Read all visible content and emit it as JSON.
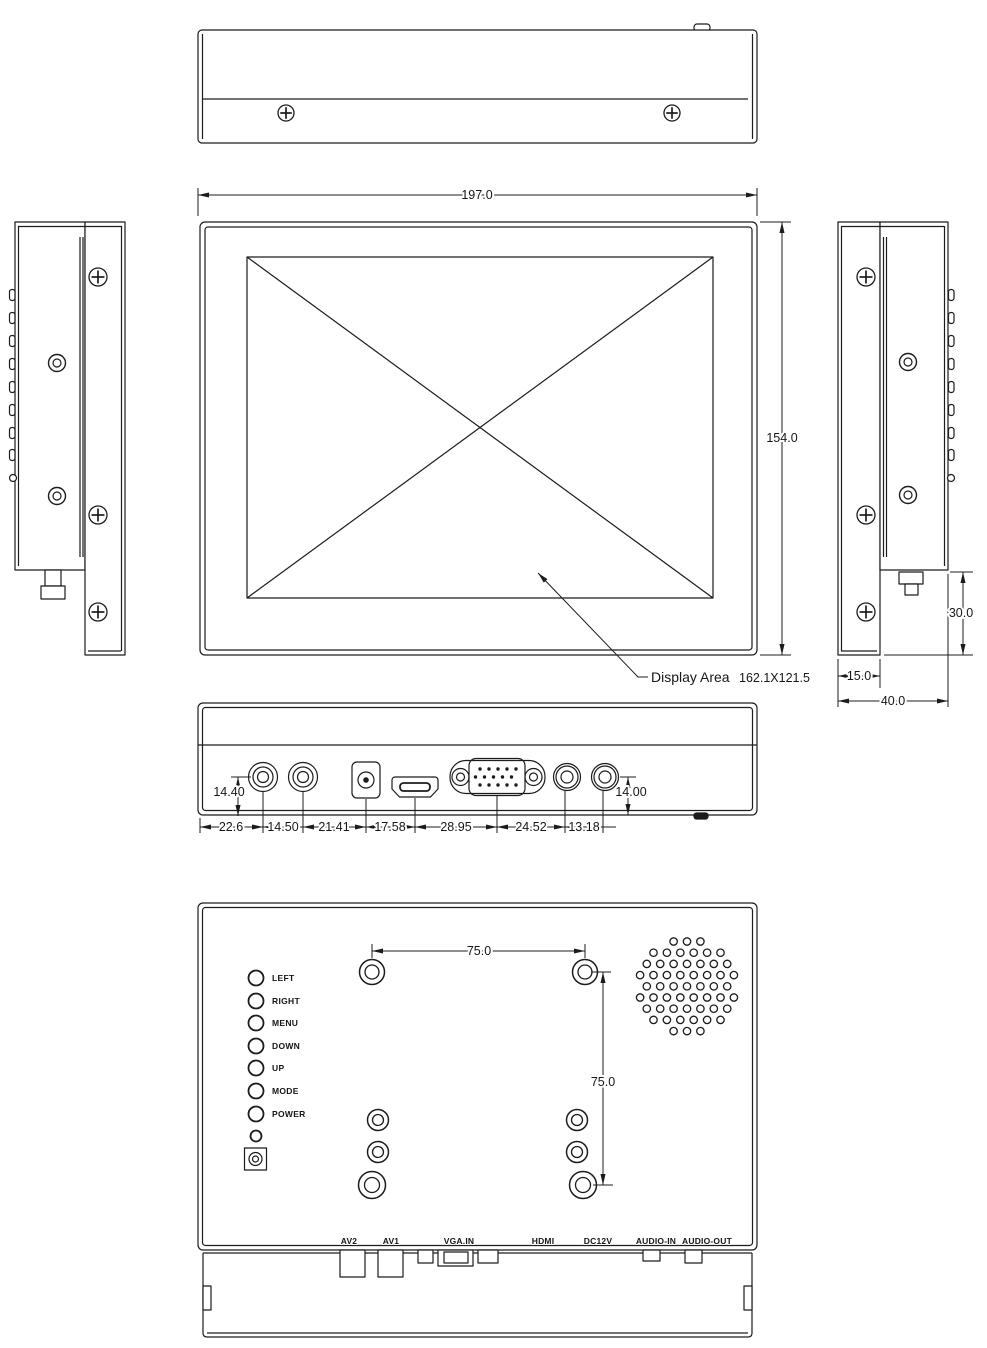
{
  "front_view": {
    "width": "197.0",
    "height": "154.0",
    "display_area": {
      "label": "Display Area",
      "size": "162.1X121.5"
    }
  },
  "side_view": {
    "mount_height": "30.0",
    "bezel_depth": "15.0",
    "total_depth": "40.0"
  },
  "bottom_view": {
    "jack_height_left": "14.40",
    "jack_height_right": "14.00",
    "spacings": [
      "22.6",
      "14.50",
      "21.41",
      "17.58",
      "28.95",
      "24.52",
      "13.18"
    ]
  },
  "back_view": {
    "vesa_horizontal": "75.0",
    "vesa_vertical": "75.0",
    "buttons": [
      "LEFT",
      "RIGHT",
      "MENU",
      "DOWN",
      "UP",
      "MODE",
      "POWER"
    ],
    "ports": [
      "AV2",
      "AV1",
      "VGA.IN",
      "HDMI",
      "DC12V",
      "AUDIO-IN",
      "AUDIO-OUT"
    ]
  },
  "colors": {
    "line": "#1c1c1c",
    "background": "#ffffff"
  }
}
